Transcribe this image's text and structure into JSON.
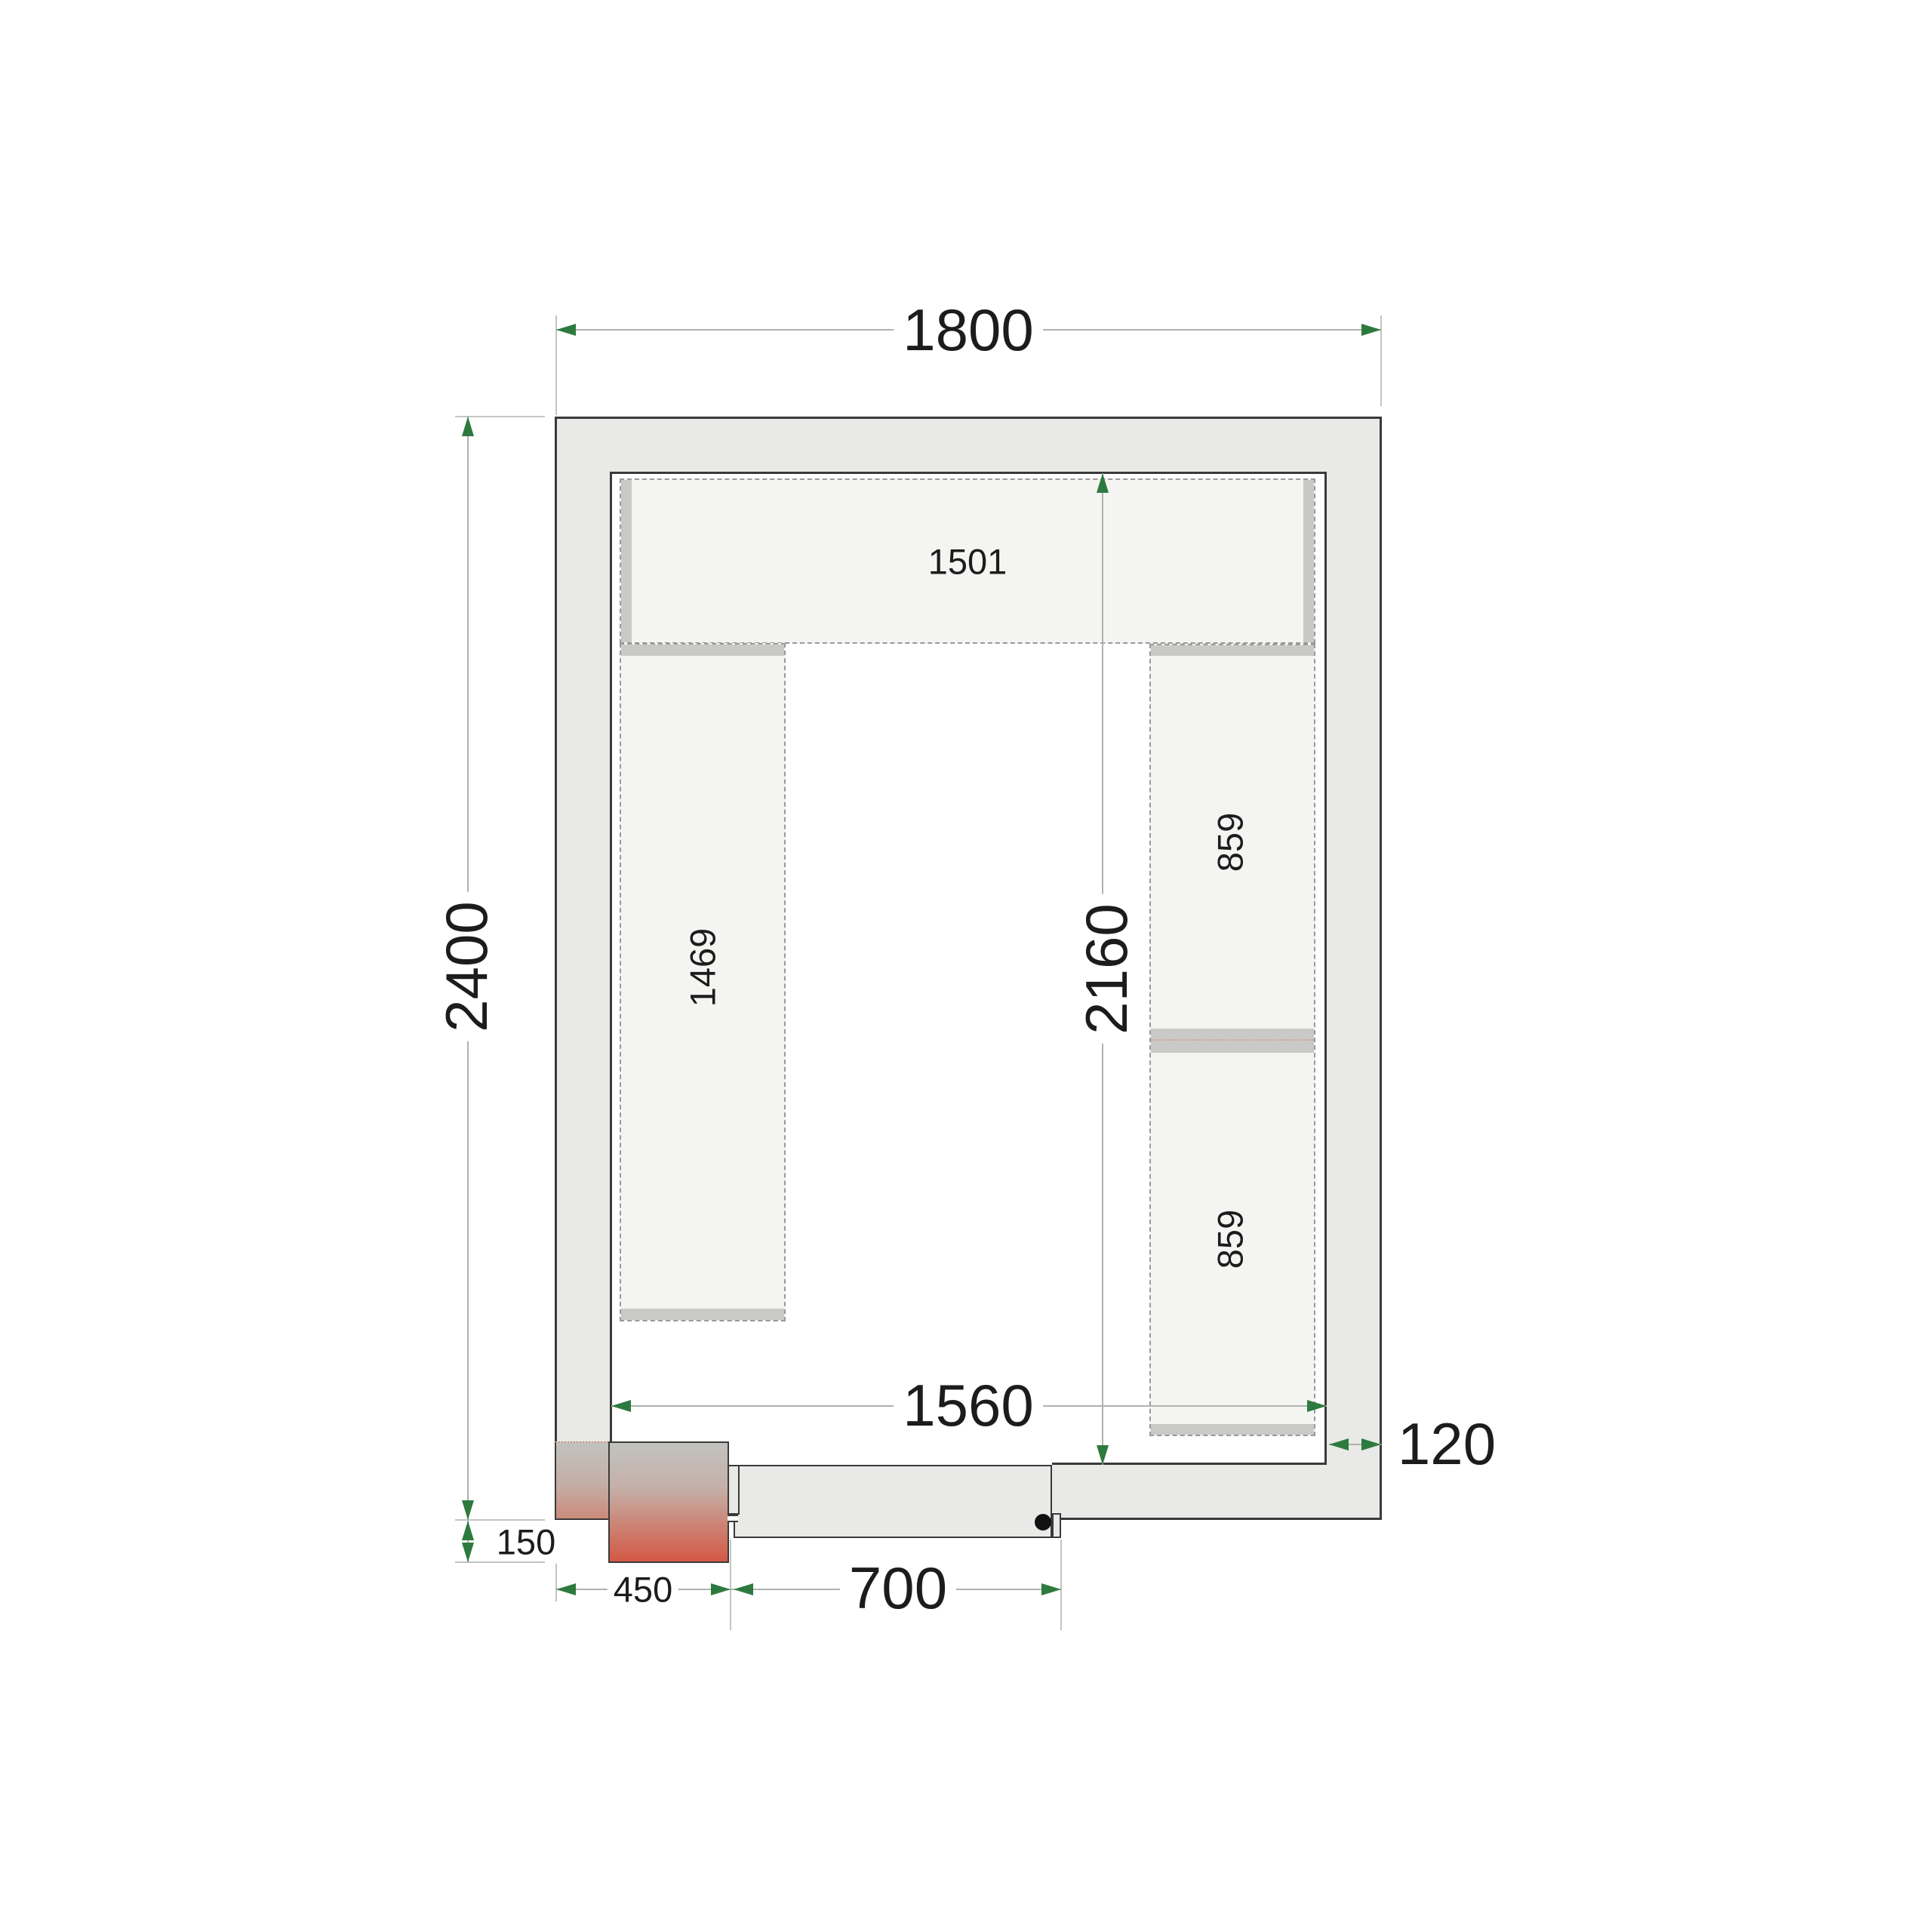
{
  "dimensions": {
    "outer_width": "1800",
    "outer_height": "2400",
    "inner_width": "1560",
    "inner_height": "2160",
    "wall_thickness": "120",
    "unit_protrusion": "150",
    "unit_width": "450",
    "door_width": "700"
  },
  "shelves": {
    "top": {
      "label": "1501"
    },
    "left": {
      "label": "1469"
    },
    "right_upper": {
      "label": "859"
    },
    "right_lower": {
      "label": "859"
    }
  },
  "colors": {
    "dimension_accent": "#2d7a3e",
    "outline_dark": "#3a3a3a",
    "wall_fill": "#e9e9e7",
    "shelf_fill": "#f4f4f2",
    "shelf_edge_band": "#c9c9c7",
    "unit_gradient_top": "#c2c2bf",
    "unit_gradient_bottom": "#d45846",
    "door_dot": "#111111"
  }
}
